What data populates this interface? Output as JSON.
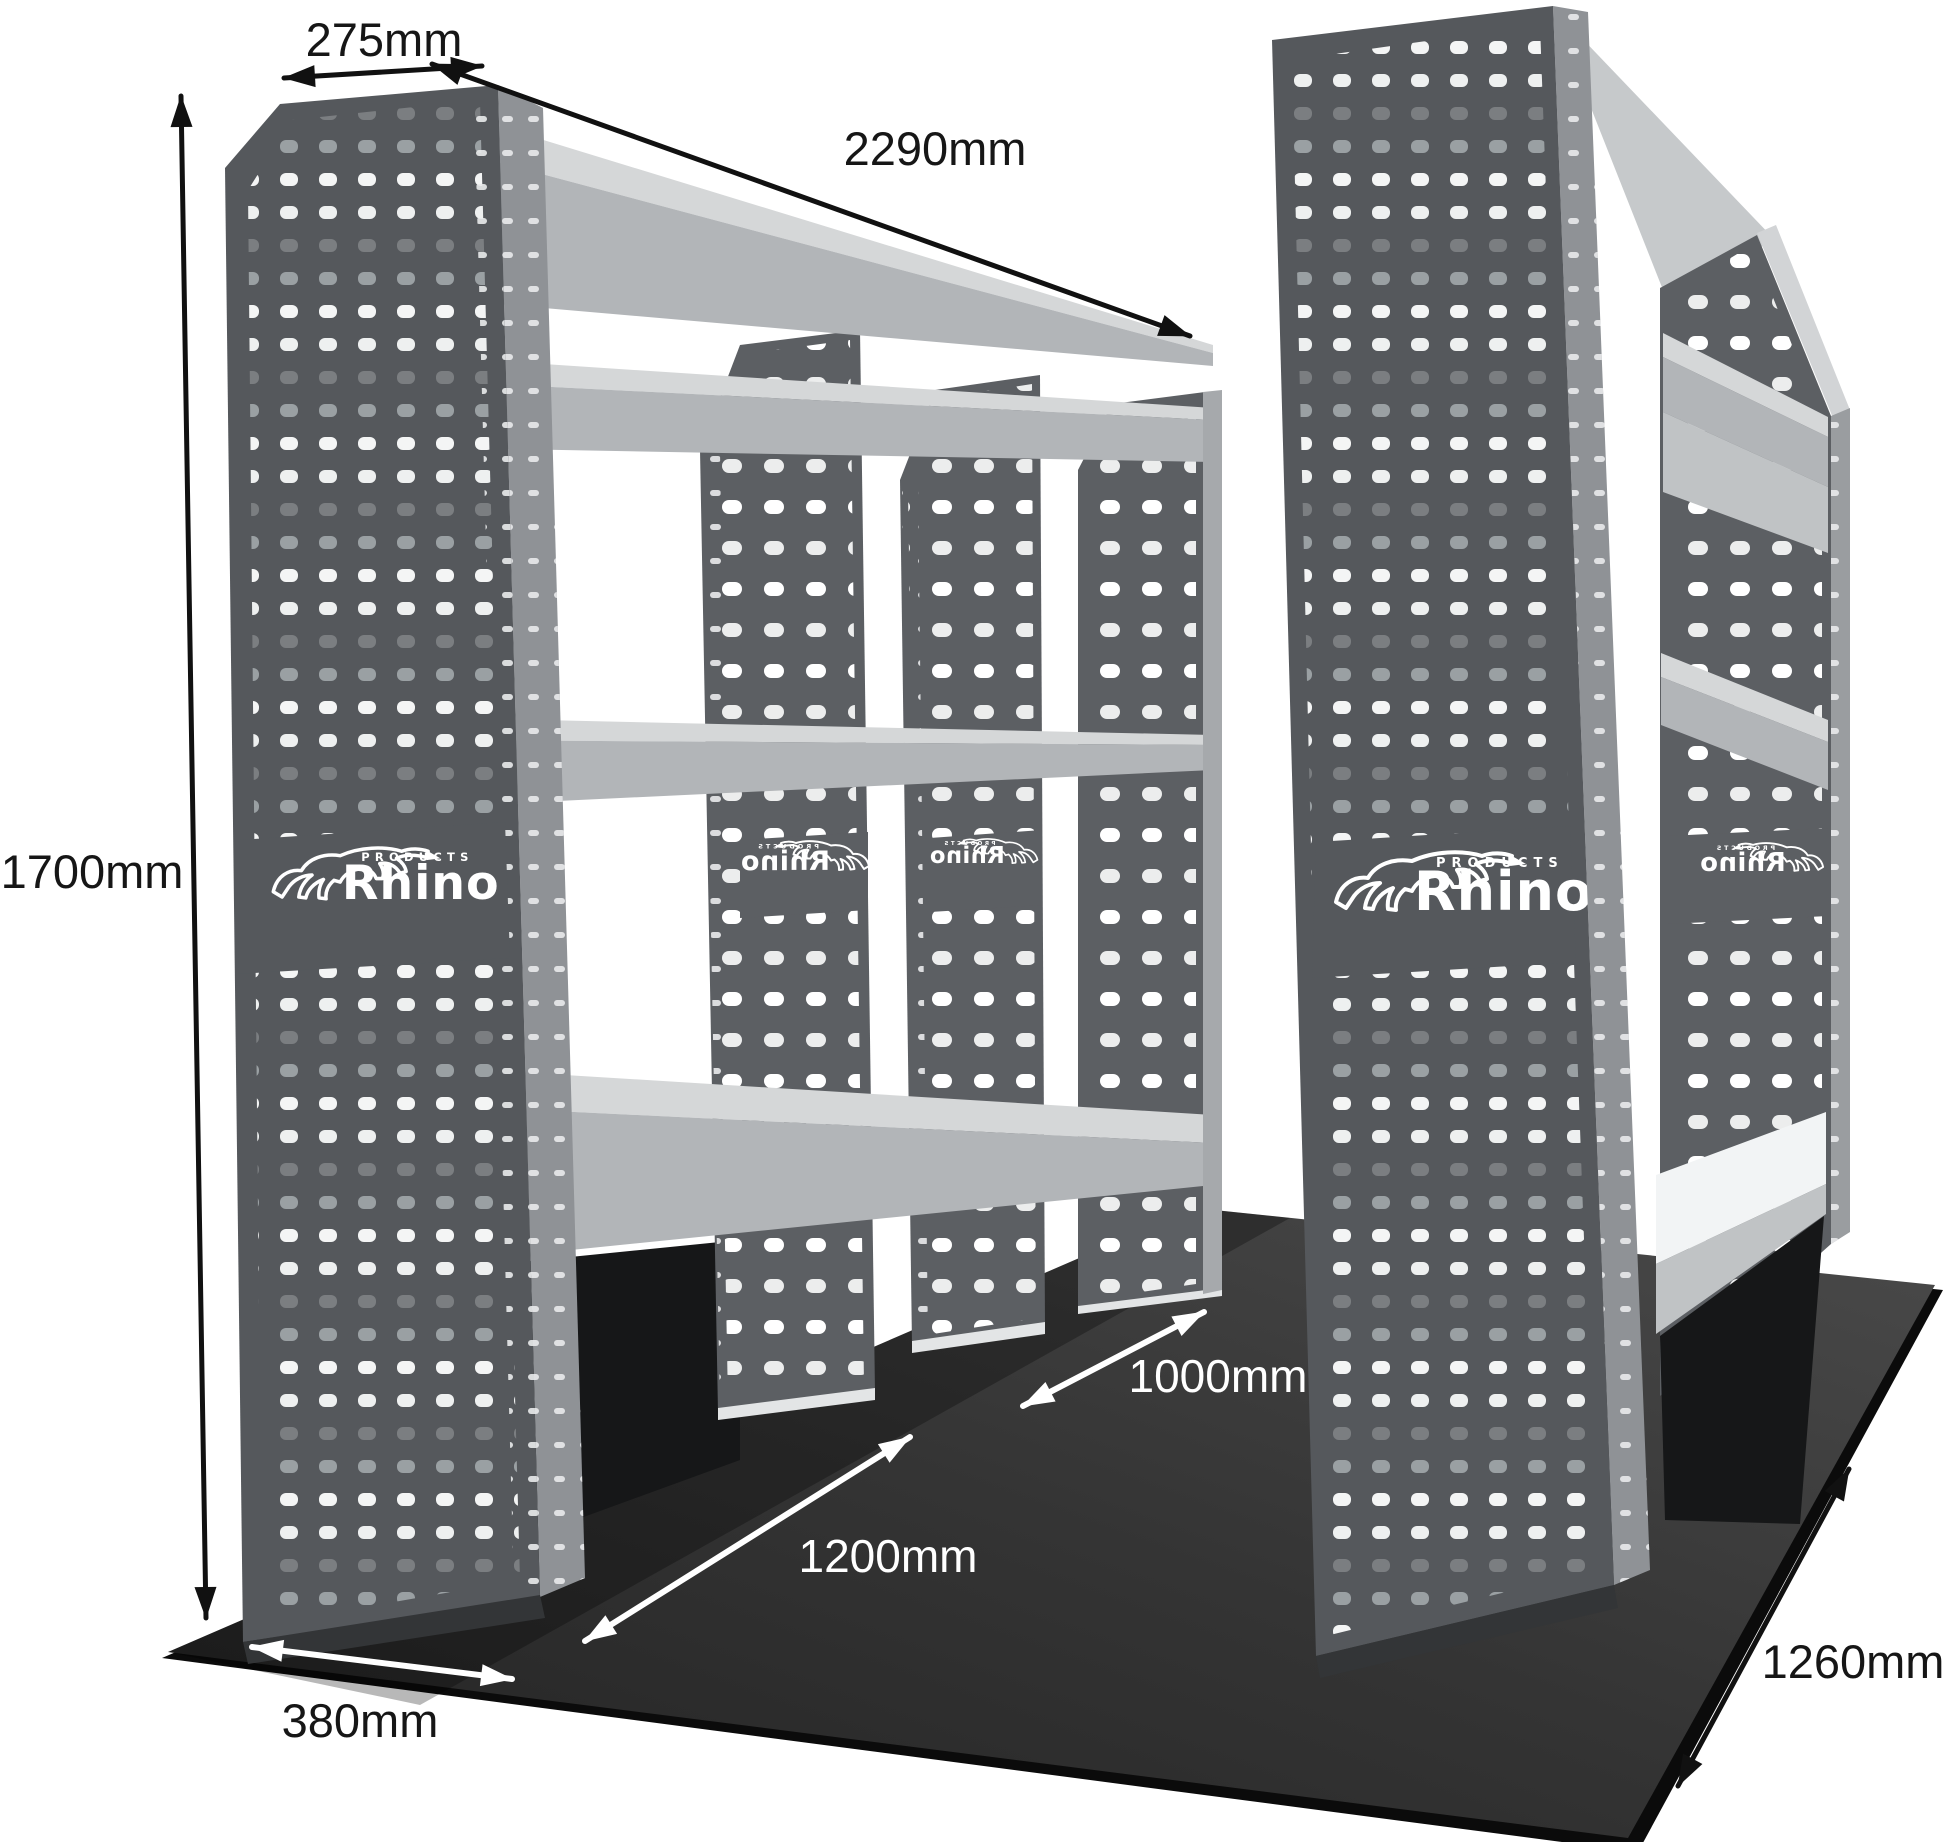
{
  "figure": {
    "type": "product-dimension-diagram",
    "subject": "Twin van racking shelving units on floor panel, perspective view"
  },
  "brand": {
    "name": "Rhino",
    "sub": "PRODUCTS"
  },
  "dimensions": {
    "top_depth": {
      "label": "275mm",
      "value_mm": 275
    },
    "length": {
      "label": "2290mm",
      "value_mm": 2290
    },
    "height": {
      "label": "1700mm",
      "value_mm": 1700
    },
    "base_depth": {
      "label": "380mm",
      "value_mm": 380
    },
    "aisle_length": {
      "label": "1200mm",
      "value_mm": 1200
    },
    "aisle_width": {
      "label": "1000mm",
      "value_mm": 1000
    },
    "floor_width": {
      "label": "1260mm",
      "value_mm": 1260
    }
  },
  "colors": {
    "background": "#ffffff",
    "panel_front": "#55585c",
    "panel_side": "#8f9296",
    "divider": "#5c5f63",
    "shelf": "#b2b5b8",
    "shelf_top": "#d5d7d8",
    "slope_top": "#c6c9cb",
    "bench_white": "#f2f4f5",
    "under_bench_black": "#161718",
    "floor_light": "#4a4a4a",
    "floor_dark": "#232323",
    "floor_edge": "#0b0b0b",
    "hole_white": "#f7f8f8",
    "hole_gray": "#9aa0a3",
    "dim_arrow_black": "#111111",
    "dim_arrow_white": "#ffffff",
    "logo": "#ffffff"
  }
}
